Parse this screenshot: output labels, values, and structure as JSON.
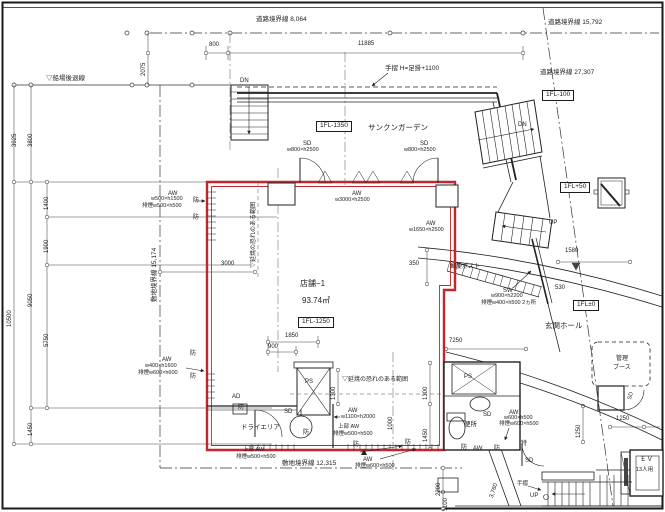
{
  "colors": {
    "ink": "#222222",
    "red": "#c2272d",
    "paper": "#ffffff"
  },
  "boundary_labels": [
    {
      "id": "road-boundary-8064",
      "t": "道路境界線  8,064",
      "x": 256,
      "y": 17,
      "s": 6.5
    },
    {
      "id": "road-boundary-15792",
      "t": "道路境界線  15,792",
      "x": 548,
      "y": 20,
      "s": 6.5
    },
    {
      "id": "road-boundary-27307",
      "t": "道路境界線  27,307",
      "x": 540,
      "y": 70,
      "s": 6.5
    },
    {
      "id": "site-boundary-15174",
      "t": "敷地境界線  15,174",
      "x": 152,
      "y": 302,
      "s": 6.5,
      "r": -90
    },
    {
      "id": "site-boundary-12315",
      "t": "敷地境界線      12,315",
      "x": 282,
      "y": 461,
      "s": 6.5
    },
    {
      "id": "senba-setback-line",
      "t": "▽船場後退線",
      "x": 46,
      "y": 76,
      "s": 6.5
    }
  ],
  "level_labels": [
    {
      "id": "level-1fl-minus1350",
      "t": "1FL-1350",
      "x": 316,
      "y": 121,
      "s": 6.5,
      "box": true
    },
    {
      "id": "level-1fl-minus1250",
      "t": "1FL-1250",
      "x": 298,
      "y": 317,
      "s": 6.5,
      "box": true
    },
    {
      "id": "level-1fl-minus100",
      "t": "1FL-100",
      "x": 542,
      "y": 90,
      "s": 6.5,
      "box": true
    },
    {
      "id": "level-1fl-plus50",
      "t": "1FL+50",
      "x": 560,
      "y": 182,
      "s": 6.5,
      "box": true
    },
    {
      "id": "level-1fl-zero",
      "t": "1FL±0",
      "x": 573,
      "y": 300,
      "s": 6.5,
      "box": true
    }
  ],
  "room_labels": [
    {
      "id": "room-shop-name",
      "t": "店舗−1",
      "x": 300,
      "y": 280,
      "s": 8
    },
    {
      "id": "room-shop-area",
      "t": "93.74㎡",
      "x": 302,
      "y": 297,
      "s": 8
    },
    {
      "id": "room-sunken-garden",
      "t": "サンクンガーデン",
      "x": 368,
      "y": 124,
      "s": 7.5
    },
    {
      "id": "room-entrance-hall",
      "t": "玄関ホール",
      "x": 545,
      "y": 322,
      "s": 7.5
    },
    {
      "id": "room-toilet",
      "t": "便所",
      "x": 464,
      "y": 422,
      "s": 6.5
    },
    {
      "id": "room-dry-area",
      "t": "ドライエリア",
      "x": 241,
      "y": 425,
      "s": 6.5
    },
    {
      "id": "room-ev",
      "t": "ＥＶ",
      "x": 640,
      "y": 457,
      "s": 6.5
    },
    {
      "id": "room-ev-capacity",
      "t": "13人用",
      "x": 636,
      "y": 468,
      "s": 5.5
    },
    {
      "id": "room-management-1",
      "t": "管理",
      "x": 616,
      "y": 356,
      "s": 6
    },
    {
      "id": "room-management-2",
      "t": "ブース",
      "x": 613,
      "y": 365,
      "s": 6
    },
    {
      "id": "mail-post",
      "t": "郵便ポスト",
      "x": 450,
      "y": 264,
      "s": 6
    },
    {
      "id": "ps-shaft-1",
      "t": "PS",
      "x": 305,
      "y": 379,
      "s": 6
    },
    {
      "id": "ps-shaft-2",
      "t": "PS",
      "x": 464,
      "y": 374,
      "s": 6
    }
  ],
  "dimension_labels": [
    {
      "id": "dim-800",
      "t": "800",
      "x": 209,
      "y": 42,
      "s": 6
    },
    {
      "id": "dim-11885",
      "t": "11885",
      "x": 358,
      "y": 41,
      "s": 6
    },
    {
      "id": "dim-2075",
      "t": "2075",
      "x": 141,
      "y": 76,
      "s": 6,
      "r": -90
    },
    {
      "id": "dim-3925",
      "t": "3925",
      "x": 12,
      "y": 147,
      "s": 6,
      "r": -90
    },
    {
      "id": "dim-3800",
      "t": "3800",
      "x": 28,
      "y": 147,
      "s": 6,
      "r": -90
    },
    {
      "id": "dim-1400",
      "t": "1400",
      "x": 44,
      "y": 210,
      "s": 6,
      "r": -90
    },
    {
      "id": "dim-1900",
      "t": "1900",
      "x": 44,
      "y": 253,
      "s": 6,
      "r": -90
    },
    {
      "id": "dim-10500",
      "t": "10500",
      "x": 7,
      "y": 327,
      "s": 6,
      "r": -90
    },
    {
      "id": "dim-9050",
      "t": "9050",
      "x": 28,
      "y": 307,
      "s": 6,
      "r": -90
    },
    {
      "id": "dim-5750",
      "t": "5750",
      "x": 44,
      "y": 347,
      "s": 6,
      "r": -90
    },
    {
      "id": "dim-1450-left",
      "t": "1450",
      "x": 28,
      "y": 436,
      "s": 6,
      "r": -90
    },
    {
      "id": "dim-3000",
      "t": "3000",
      "x": 221,
      "y": 261,
      "s": 6
    },
    {
      "id": "dim-1850",
      "t": "1850",
      "x": 285,
      "y": 333,
      "s": 6
    },
    {
      "id": "dim-900",
      "t": "900",
      "x": 268,
      "y": 344,
      "s": 6
    },
    {
      "id": "dim-1300-a",
      "t": "1300",
      "x": 331,
      "y": 400,
      "s": 6,
      "r": -90
    },
    {
      "id": "dim-1300-b",
      "t": "1300",
      "x": 423,
      "y": 400,
      "s": 6,
      "r": -90
    },
    {
      "id": "dim-1450-b",
      "t": "1450",
      "x": 423,
      "y": 442,
      "s": 6,
      "r": -90
    },
    {
      "id": "dim-1000",
      "t": "1000",
      "x": 388,
      "y": 430,
      "s": 6,
      "r": -90
    },
    {
      "id": "dim-350",
      "t": "350",
      "x": 409,
      "y": 261,
      "s": 6
    },
    {
      "id": "dim-7250",
      "t": "7250",
      "x": 449,
      "y": 338,
      "s": 6
    },
    {
      "id": "dim-1580",
      "t": "1580",
      "x": 565,
      "y": 248,
      "s": 6
    },
    {
      "id": "dim-530",
      "t": "530",
      "x": 555,
      "y": 285,
      "s": 6
    },
    {
      "id": "dim-1250-v",
      "t": "1250",
      "x": 576,
      "y": 438,
      "s": 6,
      "r": -90
    },
    {
      "id": "dim-1250-h",
      "t": "1250",
      "x": 616,
      "y": 416,
      "s": 6
    },
    {
      "id": "dim-2200",
      "t": "2200",
      "x": 436,
      "y": 496,
      "s": 6,
      "r": -90
    },
    {
      "id": "dim-1100",
      "t": "1100",
      "x": 443,
      "y": 511,
      "s": 6,
      "r": -90
    },
    {
      "id": "dim-3760",
      "t": "3,760",
      "x": 489,
      "y": 497,
      "s": 6,
      "r": -72
    }
  ],
  "opening_labels": [
    {
      "id": "door-sd-garden-left-1",
      "t": "SD",
      "x": 303,
      "y": 141,
      "s": 6
    },
    {
      "id": "door-sd-garden-left-2",
      "t": "w800×h2500",
      "x": 287,
      "y": 148,
      "s": 5.5
    },
    {
      "id": "door-sd-garden-right-1",
      "t": "SD",
      "x": 420,
      "y": 141,
      "s": 6
    },
    {
      "id": "door-sd-garden-right-2",
      "t": "w800×h2500",
      "x": 404,
      "y": 148,
      "s": 5.5
    },
    {
      "id": "window-aw-3000-1",
      "t": "AW",
      "x": 352,
      "y": 191,
      "s": 6
    },
    {
      "id": "window-aw-3000-2",
      "t": "w3000×h2500",
      "x": 335,
      "y": 198,
      "s": 5.5
    },
    {
      "id": "window-aw-1650-1",
      "t": "AW",
      "x": 426,
      "y": 221,
      "s": 6
    },
    {
      "id": "window-aw-1650-2",
      "t": "w1650×h2500",
      "x": 409,
      "y": 228,
      "s": 5.5
    },
    {
      "id": "window-aw-left-1",
      "t": "AW",
      "x": 168,
      "y": 191,
      "s": 6
    },
    {
      "id": "window-aw-left-2",
      "t": "w500×h1500",
      "x": 151,
      "y": 197,
      "s": 5.5
    },
    {
      "id": "window-aw-left-3",
      "t": "排煙w500×h500",
      "x": 142,
      "y": 204,
      "s": 5.5
    },
    {
      "id": "window-aw-left-lower-1",
      "t": "AW",
      "x": 162,
      "y": 357,
      "s": 6
    },
    {
      "id": "window-aw-left-lower-2",
      "t": "w400×h1600",
      "x": 145,
      "y": 364,
      "s": 5.5
    },
    {
      "id": "window-aw-left-lower-3",
      "t": "排煙w600×h600",
      "x": 138,
      "y": 371,
      "s": 5.5
    },
    {
      "id": "window-aw-1100-1",
      "t": "AW",
      "x": 348,
      "y": 408,
      "s": 6
    },
    {
      "id": "window-aw-1100-2",
      "t": "w1100×h2000",
      "x": 341,
      "y": 415,
      "s": 5.5
    },
    {
      "id": "window-aw-upper-mid-1",
      "t": "上部  AW",
      "x": 338,
      "y": 425,
      "s": 5.5
    },
    {
      "id": "window-aw-upper-mid-2",
      "t": "排煙w500×h500",
      "x": 333,
      "y": 432,
      "s": 5.5
    },
    {
      "id": "window-aw-upper-left-1",
      "t": "上部  AW",
      "x": 243,
      "y": 448,
      "s": 5.5
    },
    {
      "id": "window-aw-upper-left-2",
      "t": "排煙w500×h500",
      "x": 236,
      "y": 455,
      "s": 5.5
    },
    {
      "id": "window-aw-bottom-1",
      "t": "AW",
      "x": 363,
      "y": 457,
      "s": 6
    },
    {
      "id": "window-aw-bottom-2",
      "t": "排煙w600×h500",
      "x": 355,
      "y": 464,
      "s": 5.5
    },
    {
      "id": "window-sw-entrance-1",
      "t": "SW",
      "x": 503,
      "y": 288,
      "s": 6
    },
    {
      "id": "window-sw-entrance-2",
      "t": "w900×h2200",
      "x": 491,
      "y": 294,
      "s": 5.5
    },
    {
      "id": "window-sw-entrance-3",
      "t": "排煙w400×h500  2ヵ所",
      "x": 481,
      "y": 301,
      "s": 5.5
    },
    {
      "id": "window-aw-toilet-1",
      "t": "AW",
      "x": 509,
      "y": 410,
      "s": 6
    },
    {
      "id": "window-aw-toilet-2",
      "t": "w600×h500",
      "x": 504,
      "y": 416,
      "s": 5.5
    },
    {
      "id": "window-aw-toilet-3",
      "t": "排煙w600×h500",
      "x": 499,
      "y": 422,
      "s": 5.5
    },
    {
      "id": "door-sd-dry",
      "t": "SD",
      "x": 284,
      "y": 409,
      "s": 6
    },
    {
      "id": "door-sd-toilet",
      "t": "SD",
      "x": 483,
      "y": 412,
      "s": 6
    },
    {
      "id": "door-sd-entrance",
      "t": "SD",
      "x": 525,
      "y": 458,
      "s": 6
    },
    {
      "id": "door-sd-booth",
      "t": "SD",
      "x": 628,
      "y": 399,
      "s": 5.5,
      "r": -75
    },
    {
      "id": "vent-ad",
      "t": "AD",
      "x": 232,
      "y": 394,
      "s": 6
    },
    {
      "id": "label-toku",
      "t": "特",
      "x": 521,
      "y": 441,
      "s": 6
    }
  ],
  "fire_labels": [
    {
      "id": "fire-range-vertical",
      "t": "▽延焼の恐れのある範囲",
      "x": 251,
      "y": 268,
      "s": 6,
      "r": -90
    },
    {
      "id": "fire-range-horizontal",
      "t": "▽延焼の恐れのある範囲",
      "x": 342,
      "y": 377,
      "s": 6
    },
    {
      "id": "fire-mark-left-1",
      "t": "防",
      "x": 193,
      "y": 198,
      "s": 6
    },
    {
      "id": "fire-mark-left-2",
      "t": "防",
      "x": 193,
      "y": 215,
      "s": 6
    },
    {
      "id": "fire-mark-left-3",
      "t": "防",
      "x": 190,
      "y": 351,
      "s": 6
    },
    {
      "id": "fire-mark-left-4",
      "t": "防",
      "x": 190,
      "y": 374,
      "s": 6
    },
    {
      "id": "fire-mark-ad",
      "t": "防",
      "x": 238,
      "y": 405,
      "s": 6
    },
    {
      "id": "fire-mark-sd",
      "t": "防",
      "x": 303,
      "y": 430,
      "s": 6
    },
    {
      "id": "fire-mark-bottom-1",
      "t": "防",
      "x": 353,
      "y": 442,
      "s": 6
    },
    {
      "id": "fire-mark-bottom-2",
      "t": "防",
      "x": 405,
      "y": 440,
      "s": 6
    },
    {
      "id": "fire-mark-bottom-3",
      "t": "防",
      "x": 461,
      "y": 445,
      "s": 6
    },
    {
      "id": "fire-mark-bottom-aw",
      "t": "AW",
      "x": 473,
      "y": 446,
      "s": 6
    },
    {
      "id": "fire-mark-bottom-4",
      "t": "防",
      "x": 494,
      "y": 446,
      "s": 6
    }
  ],
  "circulation_labels": [
    {
      "id": "stair-dn-top",
      "t": "DN",
      "x": 240,
      "y": 78,
      "s": 6
    },
    {
      "id": "stair-dn-right",
      "t": "DN",
      "x": 518,
      "y": 122,
      "s": 6
    },
    {
      "id": "stair-up-right",
      "t": "UP",
      "x": 549,
      "y": 220,
      "s": 6
    },
    {
      "id": "stair-up-bottom",
      "t": "UP",
      "x": 530,
      "y": 493,
      "s": 6
    },
    {
      "id": "handrail-note",
      "t": "手摺  H=足掛+1100",
      "x": 385,
      "y": 66,
      "s": 6.5
    },
    {
      "id": "handrail-bottom",
      "t": "手摺",
      "x": 517,
      "y": 482,
      "s": 5.5
    }
  ]
}
